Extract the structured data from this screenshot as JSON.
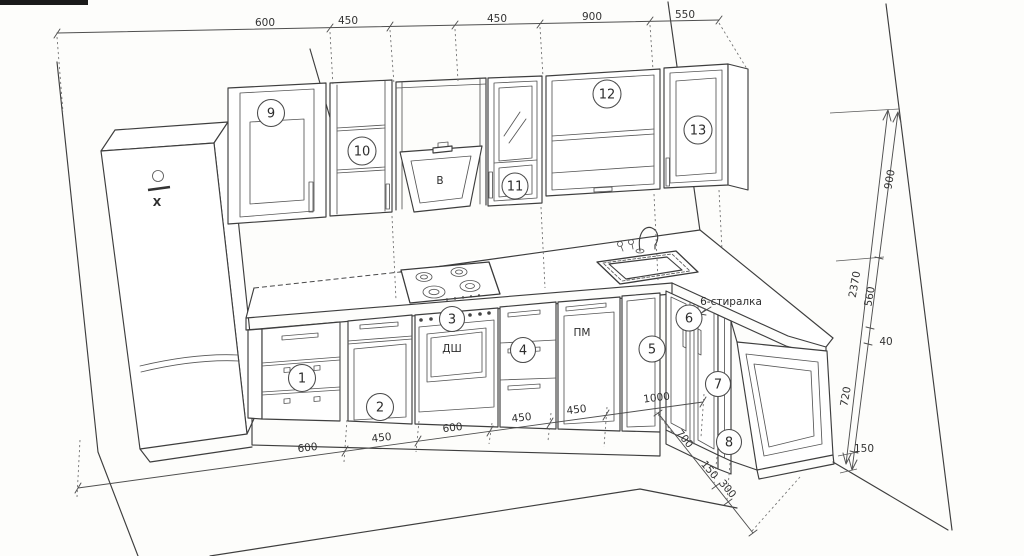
{
  "callouts": {
    "c1": "1",
    "c2": "2",
    "c3": "3",
    "c4": "4",
    "c5": "5",
    "c6": "6",
    "c7": "7",
    "c8": "8",
    "c9": "9",
    "c10": "10",
    "c11": "11",
    "c12": "12",
    "c13": "13"
  },
  "labels": {
    "hood": "В",
    "oven": "ДШ",
    "dishwasher": "ПМ",
    "fridge": "X",
    "washer_note": "6-стиралка"
  },
  "dims": {
    "top": [
      "600",
      "450",
      "450",
      "900",
      "550"
    ],
    "bottom": [
      "600",
      "450",
      "600",
      "450",
      "450",
      "1000"
    ],
    "return": [
      "700",
      "150",
      "300"
    ],
    "right": [
      "900",
      "2370",
      "560",
      "40",
      "720",
      "150"
    ]
  }
}
